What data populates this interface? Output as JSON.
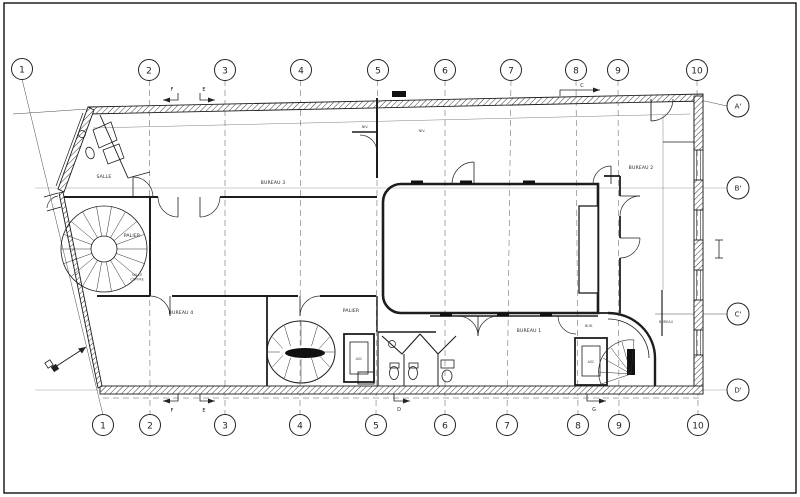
{
  "colors": {
    "ink": "#222222",
    "paper": "#ffffff"
  },
  "grid_top": [
    "1",
    "2",
    "3",
    "4",
    "5",
    "6",
    "7",
    "8",
    "9",
    "10"
  ],
  "grid_bottom": [
    "1",
    "2",
    "3",
    "4",
    "5",
    "6",
    "7",
    "8",
    "9",
    "10"
  ],
  "row_markers": [
    "A'",
    "B'",
    "C'",
    "D'"
  ],
  "rooms": {
    "salle": "SALLE",
    "palier_stair": "PALIER",
    "salle_coffre_1": "SALLE",
    "salle_coffre_2": "COFFRE",
    "bureau3": "BUREAU 3",
    "bureau4": "BUREAU 4",
    "bureau2": "BUREAU 2",
    "bureau1": "BUREAU 1",
    "palier_core": "PALIER",
    "bur": "BUR.",
    "bureau_right": "BUREAU",
    "asc_left": "ASC",
    "asc_right": "ASC",
    "niv_a": "NIV.",
    "niv_b": "NIV."
  },
  "section_markers": {
    "top_left": "F",
    "top_left2": "E",
    "top_right": "C",
    "bottom_left": "F",
    "bottom_left2": "E",
    "bottom_center": "D",
    "bottom_right": "G"
  }
}
